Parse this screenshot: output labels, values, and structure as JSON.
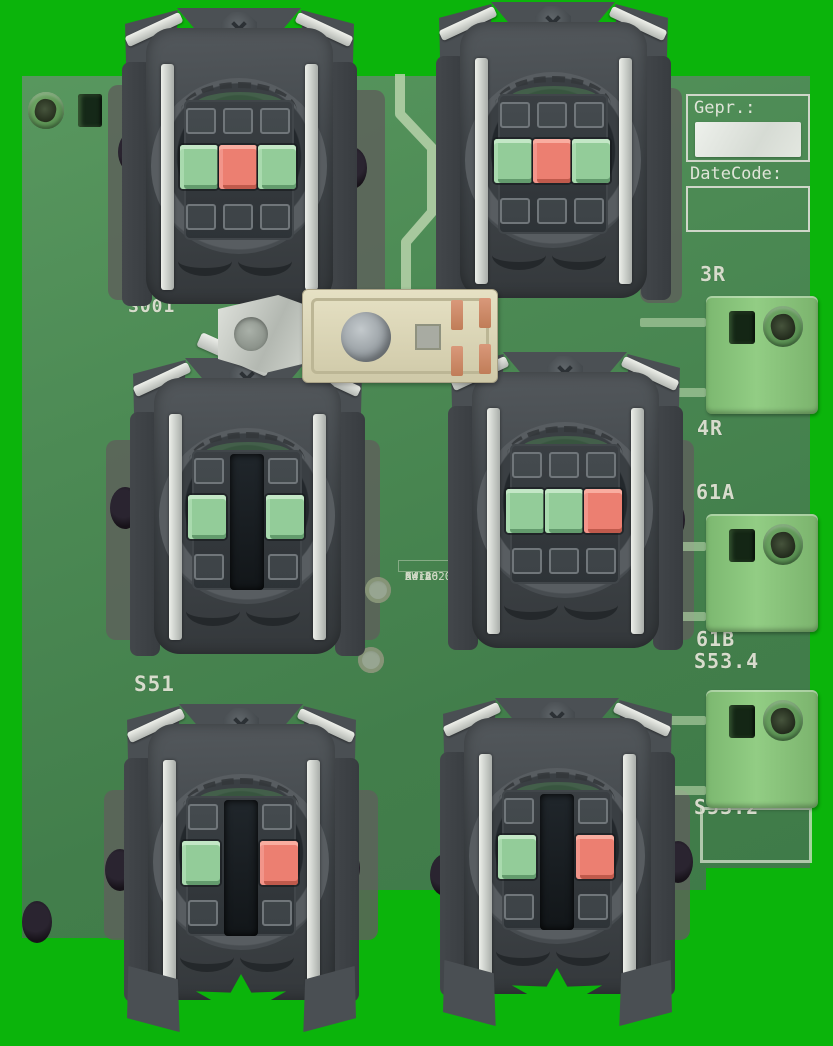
{
  "photo": {
    "subject": "printed circuit board with six pushbutton contact sockets, screw terminal blocks and a lamp holder",
    "background_color": "#0bb40b",
    "board_color": "#4c8a54",
    "terminal_color": "#8cc87f",
    "plunger_green": "#93cc99",
    "plunger_red": "#ec7f71",
    "silkscreen_color": "#d7dccc"
  },
  "silkscreen": {
    "gepr_label": "Gepr.:",
    "datecode_label": "DateCode:",
    "print_block": [
      "KW A",
      "Serv",
      "A4186",
      "04-2020"
    ],
    "board_labels": [
      {
        "text": "S001",
        "x": 128,
        "y": 296,
        "size": 18
      },
      {
        "text": "S51",
        "x": 134,
        "y": 672,
        "size": 21
      },
      {
        "text": "3R",
        "x": 700,
        "y": 262,
        "size": 20
      },
      {
        "text": "4R",
        "x": 697,
        "y": 416,
        "size": 20
      },
      {
        "text": "61A",
        "x": 696,
        "y": 480,
        "size": 20
      },
      {
        "text": "61B",
        "x": 696,
        "y": 627,
        "size": 20
      },
      {
        "text": "S53.4",
        "x": 694,
        "y": 649,
        "size": 20
      },
      {
        "text": "S53.2",
        "x": 694,
        "y": 795,
        "size": 20
      }
    ]
  },
  "sockets": [
    {
      "id": "top-left",
      "x": 122,
      "y": 8,
      "plungers": [
        "green",
        "red",
        "green"
      ],
      "star": false
    },
    {
      "id": "top-right",
      "x": 436,
      "y": 2,
      "plungers": [
        "green",
        "red",
        "green"
      ],
      "star": false
    },
    {
      "id": "middle-left",
      "x": 130,
      "y": 358,
      "plungers": [
        "green",
        "empty",
        "green"
      ],
      "star": false
    },
    {
      "id": "middle-right",
      "x": 448,
      "y": 352,
      "plungers": [
        "green",
        "green",
        "red"
      ],
      "star": false
    },
    {
      "id": "bottom-left",
      "x": 124,
      "y": 704,
      "plungers": [
        "green",
        "empty",
        "red"
      ],
      "star": true
    },
    {
      "id": "bottom-right",
      "x": 440,
      "y": 698,
      "plungers": [
        "green",
        "empty",
        "red"
      ],
      "star": true
    }
  ],
  "left_terminals": {
    "x": 20,
    "y": 78,
    "groups": [
      2,
      3,
      2,
      2,
      2,
      2
    ]
  },
  "right_terminals": {
    "x": 706,
    "blocks": [
      {
        "y": 296
      },
      {
        "y": 514
      },
      {
        "y": 690
      }
    ]
  },
  "pcb": {
    "holes": [
      [
        133,
        152
      ],
      [
        352,
        168
      ],
      [
        458,
        172
      ],
      [
        652,
        153
      ],
      [
        125,
        508
      ],
      [
        345,
        518
      ],
      [
        670,
        520
      ],
      [
        345,
        868
      ],
      [
        445,
        875
      ],
      [
        120,
        870
      ],
      [
        678,
        862
      ],
      [
        37,
        922
      ]
    ],
    "pads": [
      [
        378,
        590
      ],
      [
        371,
        660
      ]
    ],
    "bands": [
      [
        108,
        85,
        215
      ],
      [
        343,
        90,
        215
      ],
      [
        640,
        88,
        215
      ],
      [
        106,
        440,
        200
      ],
      [
        338,
        440,
        200
      ],
      [
        652,
        440,
        200
      ],
      [
        104,
        790,
        150
      ],
      [
        336,
        790,
        150
      ],
      [
        648,
        790,
        150
      ]
    ],
    "trace_stubs_y": [
      318,
      388,
      542,
      612,
      716,
      786
    ]
  }
}
